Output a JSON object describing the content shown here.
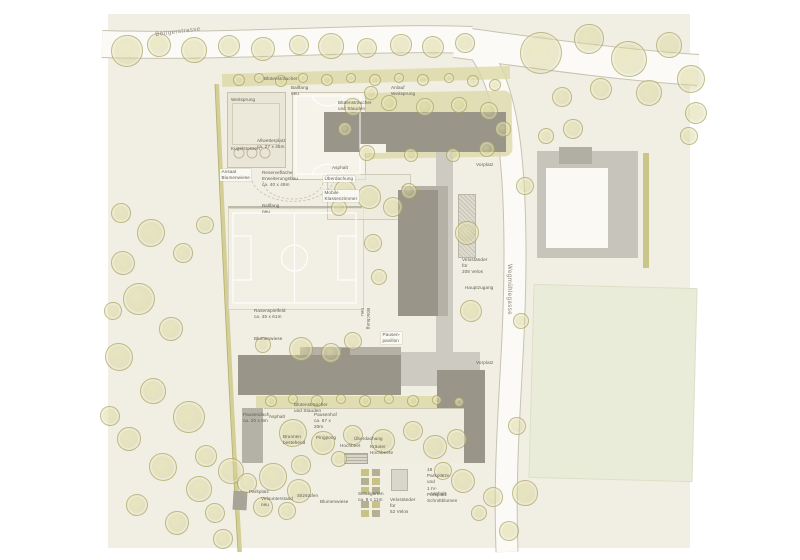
{
  "plan": {
    "colors": {
      "paper": "#ffffff",
      "ground": "#f1efe4",
      "road": "#fbfaf6",
      "road_edge": "#c7c3b0",
      "building_dark": "#999588",
      "building_light": "#b5b1a7",
      "plaza": "#cdcac1",
      "hedge": "#ddd9a8",
      "tree_stroke": "#a09a52",
      "court": "#f6f4ea",
      "lawn": "#e9ecd8",
      "label_text": "#5f5c53"
    },
    "streets": [
      {
        "id": "street-boettgerstrasse",
        "text": "Böttgerstrasse",
        "x": 155,
        "y": 32,
        "rot": -7
      },
      {
        "id": "street-wegmuehlegasse",
        "text": "Wegmühlegasse",
        "x": 512,
        "y": 264,
        "rot": 90
      }
    ],
    "labels": [
      {
        "id": "label-bluetenstraeucher-top",
        "text": "Blütensträucher",
        "x": 264,
        "y": 76
      },
      {
        "id": "label-weitsprung",
        "text": "Weitsprung",
        "x": 231,
        "y": 97
      },
      {
        "id": "label-kugelstossen",
        "text": "Kugelstossen",
        "x": 231,
        "y": 146
      },
      {
        "id": "label-ballfang-neu-1",
        "text": "Ballfang neu",
        "x": 291,
        "y": 85
      },
      {
        "id": "label-allwetterplatz",
        "text": "Allwetterplatz\nca. 27 x 45m",
        "x": 257,
        "y": 138
      },
      {
        "id": "label-anlauf-weitsprung",
        "text": "Anlauf Weitsprung",
        "x": 391,
        "y": 85
      },
      {
        "id": "label-bluetenstraeucher-stauden-1",
        "text": "Blütensträucher\nund Stauden",
        "x": 338,
        "y": 100
      },
      {
        "id": "label-vorplatz-1",
        "text": "Vorplatz",
        "x": 476,
        "y": 162
      },
      {
        "id": "label-ansaat-blumenwiese",
        "text": "Ansaat Blumenwiese",
        "x": 220,
        "y": 169,
        "boxed": true
      },
      {
        "id": "label-reserveflaeche",
        "text": "Reservefläche Erweiterungsbau\nca. 40 x 49m",
        "x": 262,
        "y": 170
      },
      {
        "id": "label-asphalt-1",
        "text": "Asphalt",
        "x": 332,
        "y": 165
      },
      {
        "id": "label-ueberdachung-1",
        "text": "Überdachung",
        "x": 323,
        "y": 176,
        "boxed": true
      },
      {
        "id": "label-mobile-klassenzimmer",
        "text": "Mobile Klassenzimmer",
        "x": 323,
        "y": 190,
        "boxed": true
      },
      {
        "id": "label-ballfang-neu-2",
        "text": "Ballfang neu",
        "x": 262,
        "y": 203
      },
      {
        "id": "label-velostaender-208",
        "text": "Veloständer für\n208 Velos",
        "x": 462,
        "y": 257
      },
      {
        "id": "label-hauptzugang",
        "text": "Hauptzugang",
        "x": 465,
        "y": 285
      },
      {
        "id": "label-rasenspielfeld",
        "text": "Rasenspielfeld\nca. 45 x 61m",
        "x": 254,
        "y": 308
      },
      {
        "id": "label-blumenwiese-1",
        "text": "Blumenwiese",
        "x": 254,
        "y": 336
      },
      {
        "id": "label-boeschung-neu",
        "text": "Böschung neu",
        "x": 371,
        "y": 308,
        "rot": 90
      },
      {
        "id": "label-pausenpavillon",
        "text": "Pausen-\npavillon",
        "x": 381,
        "y": 332,
        "boxed": true
      },
      {
        "id": "label-vorplatz-2",
        "text": "Vorplatz",
        "x": 476,
        "y": 360
      },
      {
        "id": "label-bluetenstraeucher-stauden-2",
        "text": "Blütensträucher\nund Stauden",
        "x": 294,
        "y": 402
      },
      {
        "id": "label-pausendach",
        "text": "Pausendach\nca. 20 x 8m",
        "x": 243,
        "y": 412
      },
      {
        "id": "label-asphalt-2",
        "text": "Asphalt",
        "x": 269,
        "y": 414
      },
      {
        "id": "label-pausenhof",
        "text": "Pausenhof\nca. 67 x 20m",
        "x": 314,
        "y": 412
      },
      {
        "id": "label-brunnen-bestehend",
        "text": "Brunnen\nbestehend",
        "x": 283,
        "y": 434
      },
      {
        "id": "label-pingpong",
        "text": "Pingpong",
        "x": 316,
        "y": 435
      },
      {
        "id": "label-hochbeet",
        "text": "Hochbeet",
        "x": 340,
        "y": 443
      },
      {
        "id": "label-ueberdachung-2",
        "text": "Überdachung",
        "x": 354,
        "y": 436
      },
      {
        "id": "label-kraeuter-hochbeete",
        "text": "Kräuter Hochbeete",
        "x": 370,
        "y": 444
      },
      {
        "id": "label-parkplaetze-18",
        "text": "18 Parkplätze und\n1 IV-Parkplatz",
        "x": 427,
        "y": 467
      },
      {
        "id": "label-asphalt-3",
        "text": "Asphalt",
        "x": 430,
        "y": 491
      },
      {
        "id": "label-schnittblumen",
        "text": "Schnittblumen",
        "x": 427,
        "y": 498
      },
      {
        "id": "label-parkplatz",
        "text": "Parkplatz",
        "x": 249,
        "y": 489
      },
      {
        "id": "label-velounterstand-neu",
        "text": "Velounterstand\nneu",
        "x": 261,
        "y": 496
      },
      {
        "id": "label-sitzstufen",
        "text": "Sitzstufen",
        "x": 297,
        "y": 493
      },
      {
        "id": "label-blumenwiese-2",
        "text": "Blumenwiese",
        "x": 320,
        "y": 499
      },
      {
        "id": "label-schulgarten",
        "text": "Schulgarten\nca. 8 x 11m",
        "x": 358,
        "y": 491
      },
      {
        "id": "label-velostaender-52",
        "text": "Veloständer für\n52 Velos",
        "x": 390,
        "y": 497
      }
    ]
  }
}
